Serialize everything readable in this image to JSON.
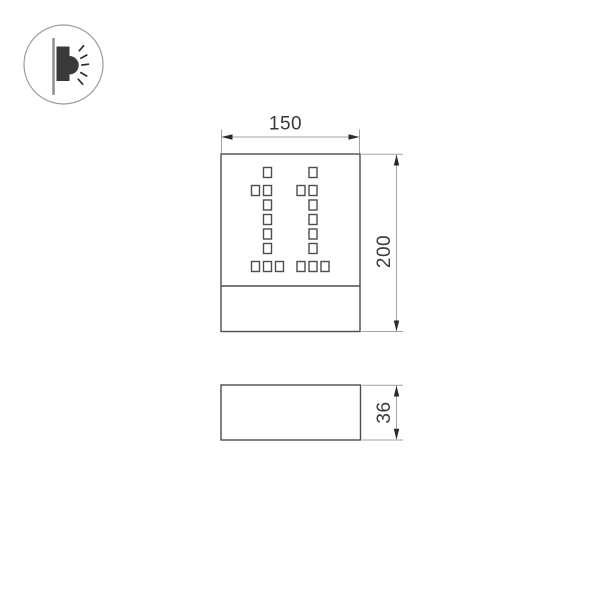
{
  "canvas": {
    "width": "605",
    "height": "605",
    "background": "#ffffff"
  },
  "icon": {
    "name": "wall-washer-light",
    "description": "pictogram of a wall-mounted side-emitting luminaire with light rays"
  },
  "front_view": {
    "width_label": "150",
    "height_label": "200",
    "cutout_pattern": "11",
    "cutout_squares_per_digit": 10
  },
  "side_view": {
    "depth_label": "36"
  },
  "colors": {
    "outline": "#4d4d4d",
    "dimension_lines": "#a3a3a3",
    "arrows": "#2b2b2b",
    "text": "#3a3a3a",
    "icon_fill": "#3a3a3a"
  }
}
